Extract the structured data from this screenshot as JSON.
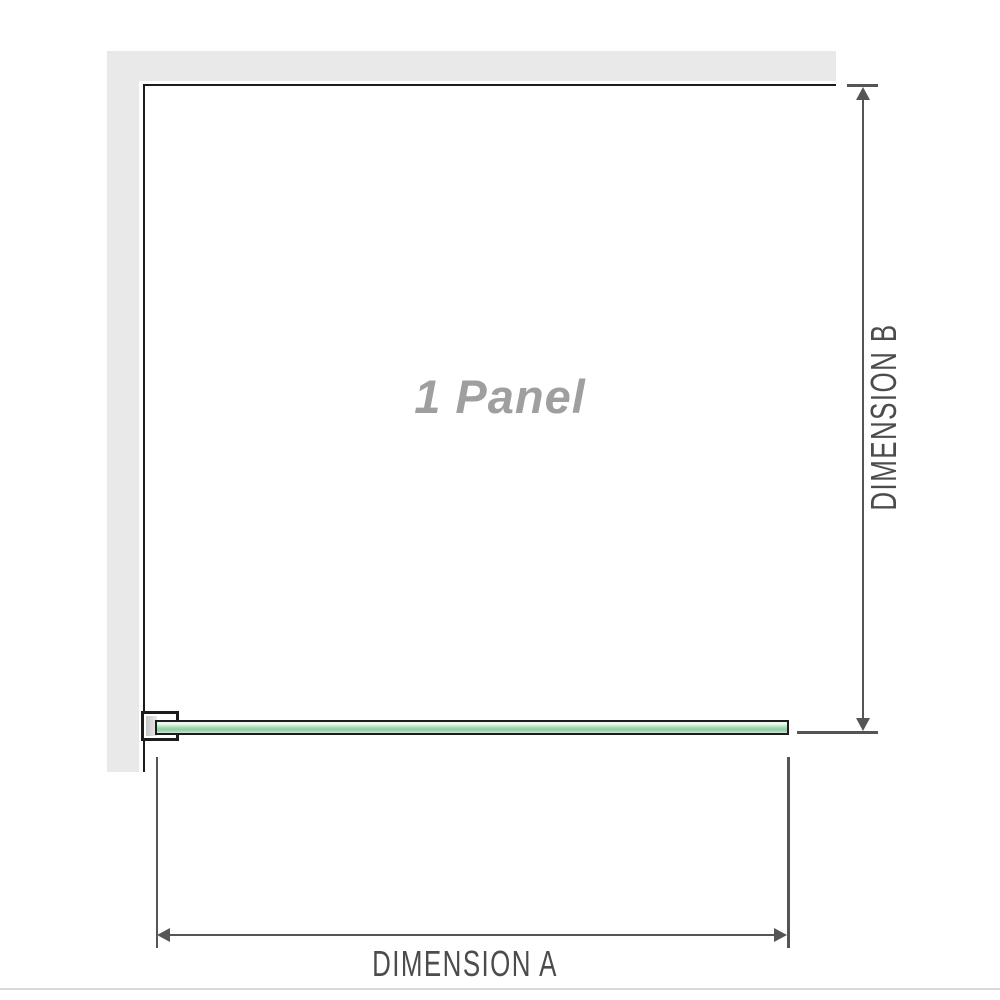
{
  "panel": {
    "label": "1 Panel"
  },
  "dimensions": {
    "vertical": {
      "label": "DIMENSION B"
    },
    "horizontal": {
      "label": "DIMENSION A"
    }
  },
  "colors": {
    "background": "#ffffff",
    "wall": "#e9e9e9",
    "outline": "#1c1c1c",
    "dimension_line": "#555555",
    "dimension_text": "#4c4c4c",
    "panel_label": "#9f9f9f",
    "glass_light": "#edf7ef",
    "glass_mid": "#a6dab5",
    "glass_dark": "#8fcda2",
    "glass_bottom": "#c8e8d2",
    "bracket_pad": "#c8c8c8",
    "bracket_pad_light": "#e8e8e8",
    "separator": "#dcd9d5"
  }
}
